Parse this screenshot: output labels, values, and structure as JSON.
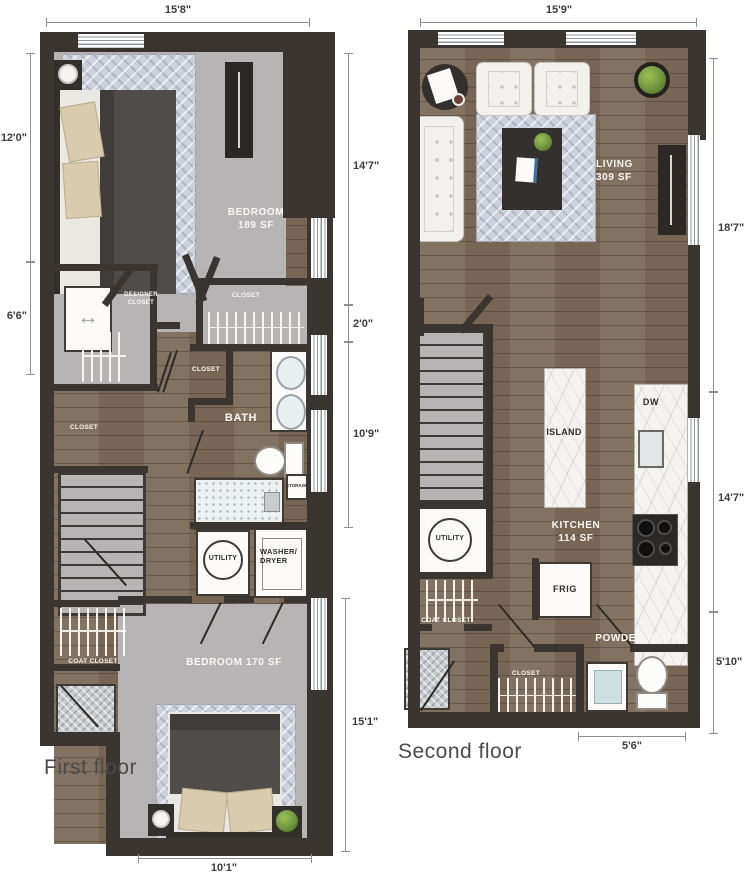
{
  "colors": {
    "wall": "#3a3530",
    "wood": "#7d6c5b",
    "carpet": "#b7b4b6",
    "rug": "#ccd1dc",
    "marble": "#f4f3f0",
    "stairs": "#b6b4b5",
    "dim_text": "#3c3c3c",
    "room_text": "#f8f7f4",
    "dark_text": "#2f2d2a",
    "plant": "#6f9440",
    "background": "#ffffff"
  },
  "icons": {
    "double_arrow": "↔"
  },
  "first_floor": {
    "caption": "First floor",
    "dims": {
      "top": "15'8\"",
      "left_upper": "12'0\"",
      "left_lower": "6'6\"",
      "right_upper": "14'7\"",
      "right_mid": "2'0\"",
      "right_lower": "10'9\"",
      "right_bottom": "15'1\"",
      "bottom": "10'1\""
    },
    "rooms": {
      "bedroom1_name": "BEDROOM",
      "bedroom1_area": "189 SF",
      "designer_closet": "DESIGNER CLOSET",
      "closet_right": "CLOSET",
      "closet_mid": "CLOSET",
      "closet_left": "CLOSET",
      "bath": "BATH",
      "storage": "STORAGE",
      "utility": "UTILITY",
      "washer_dryer": "WASHER/ DRYER",
      "coat_closet": "COAT CLOSET",
      "bedroom2": "BEDROOM 170 SF"
    }
  },
  "second_floor": {
    "caption": "Second floor",
    "dims": {
      "top": "15'9\"",
      "right_upper": "18'7\"",
      "right_mid": "14'7\"",
      "right_lower": "5'10\"",
      "bottom": "5'6\""
    },
    "rooms": {
      "living_name": "LIVING",
      "living_area": "309 SF",
      "island": "ISLAND",
      "dw": "DW",
      "kitchen_name": "KITCHEN",
      "kitchen_area": "114 SF",
      "frig": "FRIG",
      "utility": "UTILITY",
      "coat_closet": "COAT CLOSET",
      "powder_room": "POWDER ROOM",
      "closet": "CLOSET"
    }
  }
}
